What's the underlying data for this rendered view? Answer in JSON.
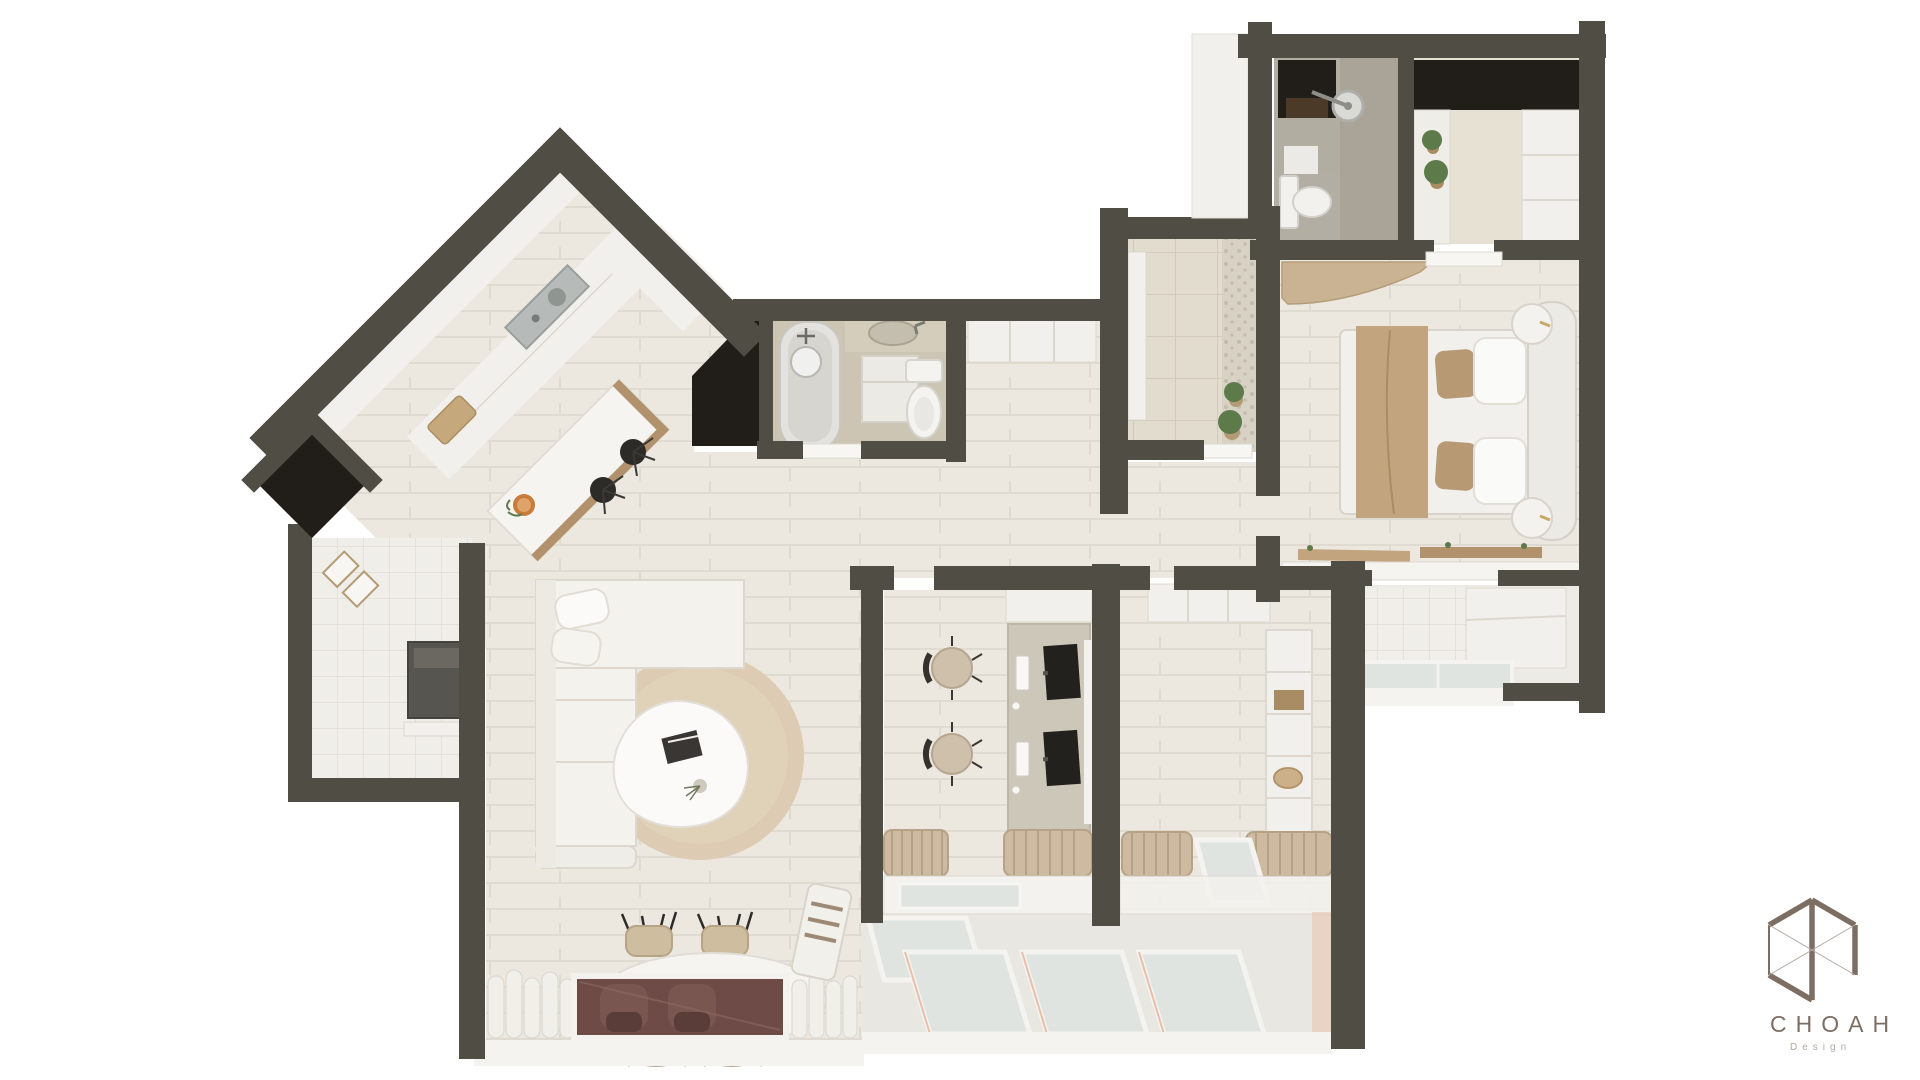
{
  "logo": {
    "brand": "CHOAH",
    "subtitle": "Design",
    "color": "#7d6e63",
    "icon": "cube-wireframe-icon"
  },
  "palette": {
    "bg": "#ffffff",
    "wall": "#4f4d44",
    "void": "#211e19",
    "wood": "#ece8e0",
    "plank": "#e0dbd1",
    "white_top": "#f2f0ec",
    "white_edge": "#dcd8d0",
    "tile": "#e2dccf",
    "tile_line": "#d2cbbb",
    "bath_floor": "#ccc5b3",
    "bath_tile": "#b3aea3",
    "pebble": "#d8d2c5",
    "pebble_dot": "#c3bcab",
    "rug": "#ddccb3",
    "tan": "#c2a47e",
    "tan2": "#b2926c",
    "wood_furn": "#c9b393",
    "wood_mid": "#a98c64",
    "dark_item": "#2c2b28",
    "gray_item": "#b6bab8",
    "desk": "#ccc7b9",
    "maroon": "#6e4b46",
    "maroon2": "#5a3c38",
    "glass": "#e0e4e1",
    "plant": "#5d7a4a",
    "pink": "#e8bfa8",
    "logo": "#7d6e63",
    "logo_light": "#b4aaa2"
  },
  "scene": {
    "type": "3d-floor-plan-render",
    "rooms": [
      {
        "name": "kitchen"
      },
      {
        "name": "living-room"
      },
      {
        "name": "dining-area"
      },
      {
        "name": "bathroom"
      },
      {
        "name": "entrance-foyer"
      },
      {
        "name": "ensuite-bathroom"
      },
      {
        "name": "walk-in-closet"
      },
      {
        "name": "master-bedroom"
      },
      {
        "name": "study-room"
      },
      {
        "name": "second-bedroom"
      },
      {
        "name": "utility-room"
      },
      {
        "name": "balcony"
      },
      {
        "name": "rear-balcony"
      },
      {
        "name": "wardrobe-corridor"
      }
    ]
  }
}
